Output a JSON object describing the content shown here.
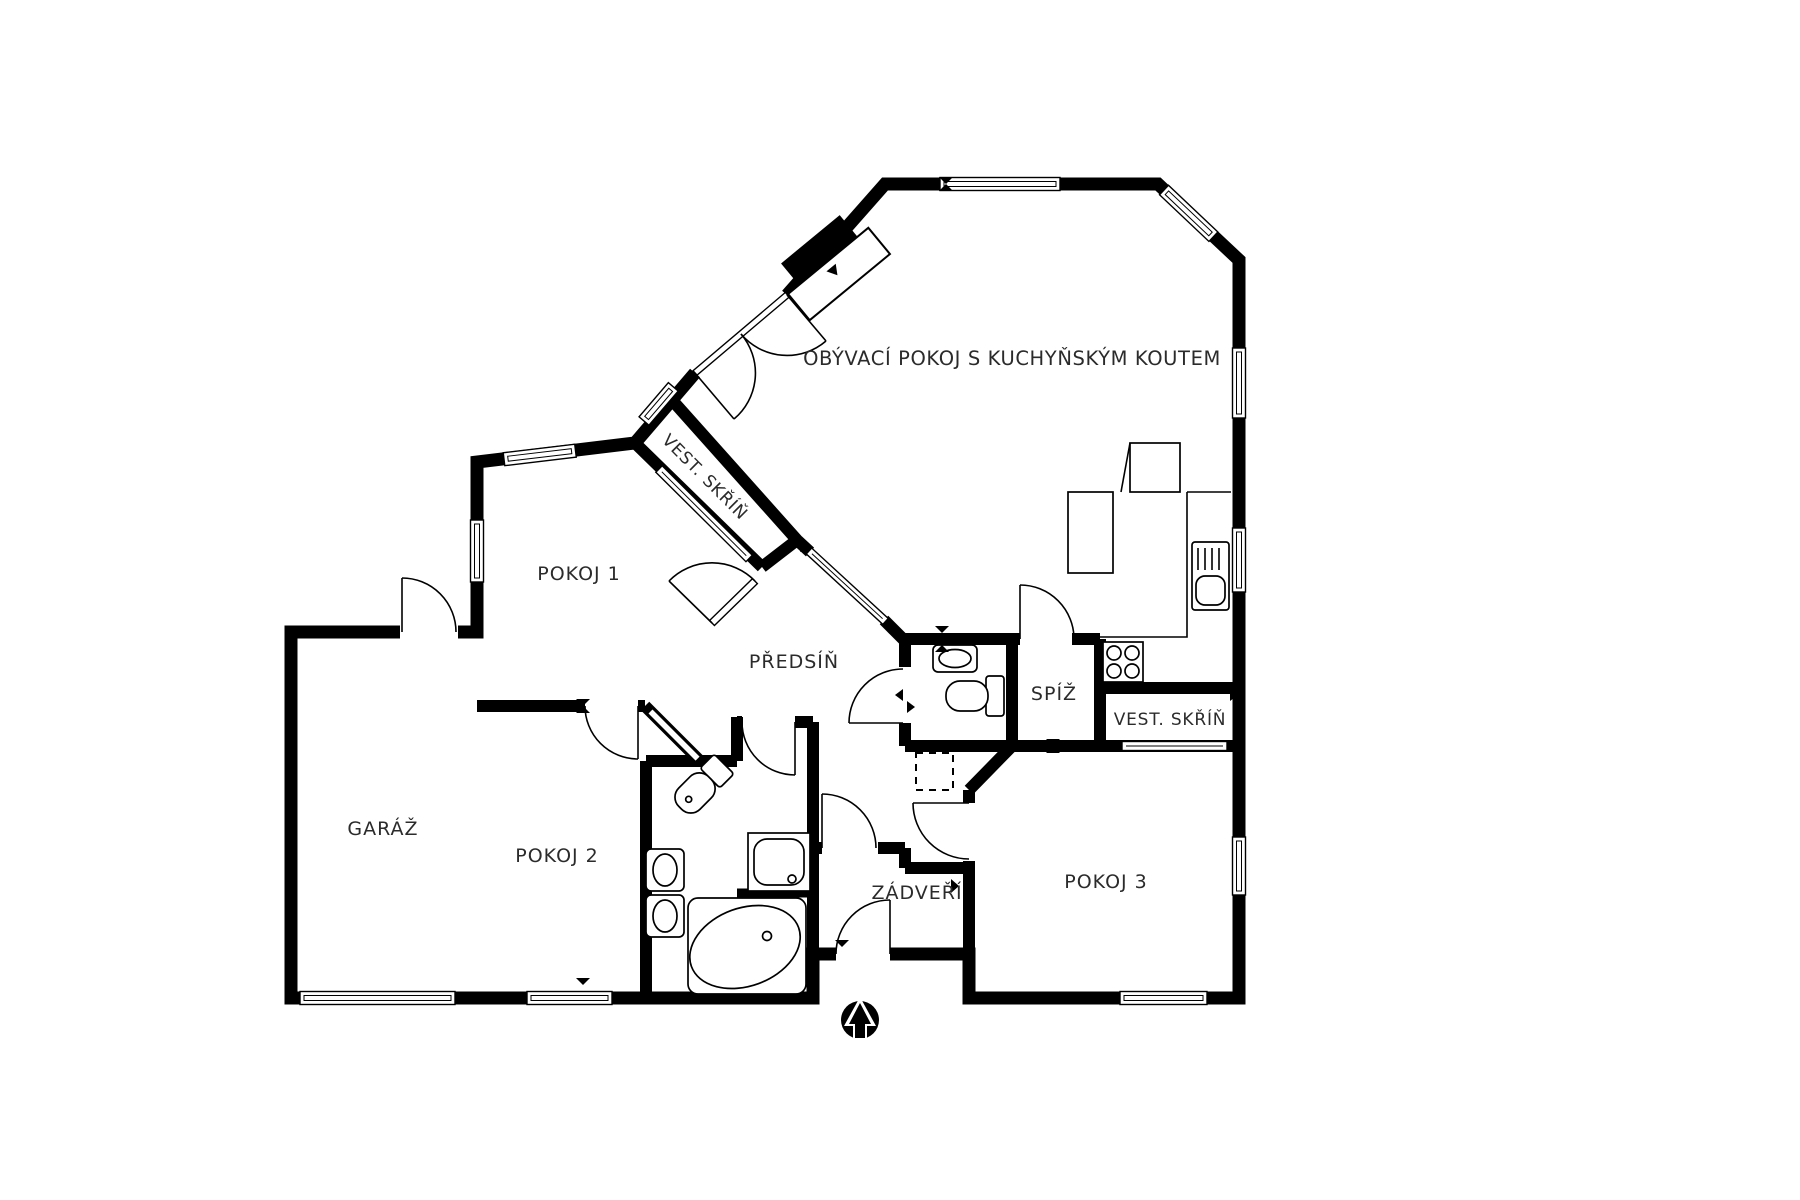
{
  "floor_plan": {
    "background_color": "#ffffff",
    "wall_color": "#000000",
    "label_color": "#2b2b2b",
    "rooms": [
      {
        "id": "living-room-kitchen",
        "label": "OBÝVACÍ POKOJ S KUCHYŇSKÝM KOUTEM"
      },
      {
        "id": "wardrobe-hall",
        "label": "VEST. SKŘÍŇ"
      },
      {
        "id": "room-1",
        "label": "POKOJ 1"
      },
      {
        "id": "hallway",
        "label": "PŘEDSÍŇ"
      },
      {
        "id": "pantry",
        "label": "SPÍŽ"
      },
      {
        "id": "wardrobe-2",
        "label": "VEST. SKŘÍŇ"
      },
      {
        "id": "garage",
        "label": "GARÁŽ"
      },
      {
        "id": "room-2",
        "label": "POKOJ 2"
      },
      {
        "id": "vestibule",
        "label": "ZÁDVEŘÍ"
      },
      {
        "id": "room-3",
        "label": "POKOJ 3"
      }
    ],
    "icons": {
      "north_arrow": "north-arrow-icon"
    }
  }
}
